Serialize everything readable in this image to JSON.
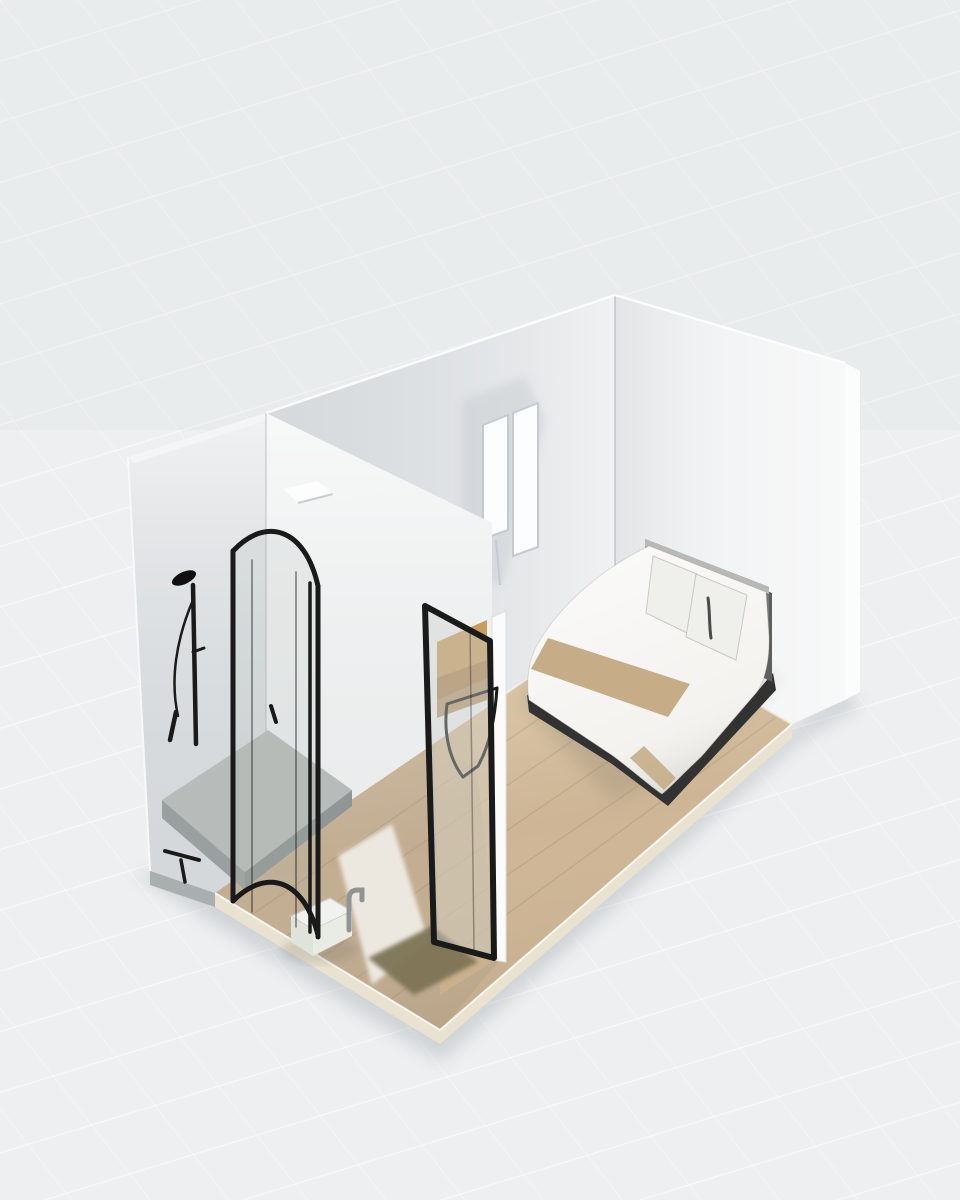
{
  "viewport": {
    "type": "3d-room-planner-view",
    "projection": "isometric",
    "visible_text": ""
  },
  "colors": {
    "background": "#edeff0",
    "grid_line": "#ffffff",
    "wall_west": "#e2e5e7",
    "wall_top_strip": "#f3f5f6",
    "partition_wall": "#f5f6f6",
    "bedroom_back_wall": "#e3e6e8",
    "right_wall": "#f1f2f3",
    "right_wall_edge": "#fbfcfc",
    "floor_wood": "#cdb595",
    "slab_edge": "#eae2d0",
    "slab_side_gray": "#a9aeae",
    "shower_tray": "#b7bbb9",
    "black_frame": "#1a1a1a",
    "window_glass": "#fbfdfe",
    "window_frame": "#c4cad0",
    "door_jamb": "#fafbfa",
    "through_door_wood": "#c89b61",
    "fixture_white": "#f1f2ef",
    "fixture_side": "#e0e2dc",
    "faucet_gray": "#8f9495",
    "mat_dark": "#7e7557",
    "mat_white": "#f4f3ee",
    "bed_duvet": "#f4f3f0",
    "bed_runner": "#c3a981",
    "bed_headboard": "#8f8f8f",
    "bed_headboard_top": "#b8b8b6",
    "bed_frame": "#323232",
    "pillow": "#efefec",
    "pillow_stripe": "#4a4a48",
    "light_fixture": "#fdfdfd"
  },
  "objects": [
    {
      "id": "west-wall",
      "label": "exterior side wall"
    },
    {
      "id": "partition-wall",
      "label": "bathroom partition wall"
    },
    {
      "id": "back-wall",
      "label": "bedroom back wall"
    },
    {
      "id": "right-wall",
      "label": "bedroom side wall"
    },
    {
      "id": "floor",
      "label": "wood floor"
    },
    {
      "id": "window",
      "label": "two-pane window"
    },
    {
      "id": "shower",
      "label": "curved glass shower enclosure"
    },
    {
      "id": "shower-column",
      "label": "black shower fixture"
    },
    {
      "id": "toilet",
      "label": "small bathroom fixture with faucet"
    },
    {
      "id": "interior-door",
      "label": "open black-framed glass door"
    },
    {
      "id": "chair",
      "label": "black wire chair"
    },
    {
      "id": "bed",
      "label": "single bed with runner"
    },
    {
      "id": "floor-mat",
      "label": "dark floor mat"
    }
  ]
}
